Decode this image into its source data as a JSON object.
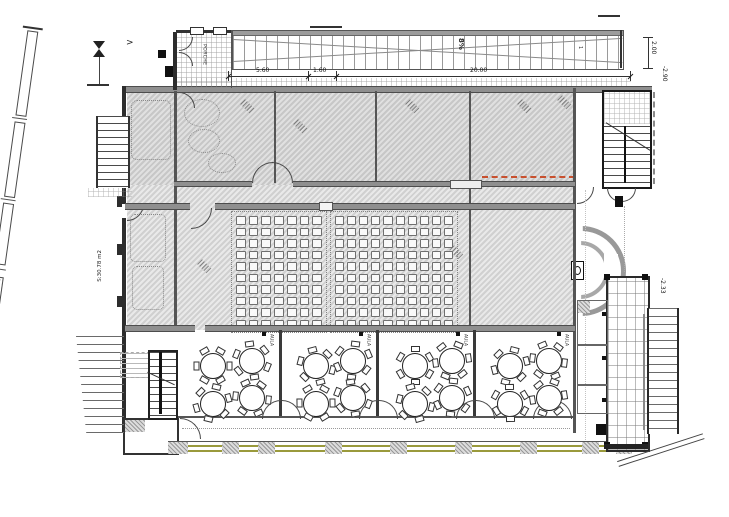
{
  "drawing": {
    "labels": {
      "porch": "PORCHE",
      "ramp_slope": "8%",
      "ramp_note": "1",
      "north_arrow": ">"
    },
    "dimensions": {
      "porch_width": "5.60",
      "gap": "1.60",
      "ramp_length": "20.00",
      "ramp_width": "2.00",
      "level_ramp_base": "-2.90",
      "level_walkway": "-2.33",
      "stair_area": "S:30.78 m2"
    },
    "auditorium": {
      "left_block": {
        "rows": 10,
        "cols": 7
      },
      "right_block": {
        "rows": 10,
        "cols": 10
      }
    },
    "classrooms": [
      {
        "label": "AULA",
        "tables": 4,
        "chairs_per_table": 6
      },
      {
        "label": "AULA",
        "tables": 4,
        "chairs_per_table": 6
      },
      {
        "label": "AULA",
        "tables": 4,
        "chairs_per_table": 6
      },
      {
        "label": "AULA",
        "tables": 4,
        "chairs_per_table": 6
      }
    ],
    "colors": {
      "wall": "#2d2d2d",
      "hatch": "#d2d2d2",
      "accent_dashed": "#c8502e",
      "facade_olive": "#9a9a3c"
    }
  }
}
